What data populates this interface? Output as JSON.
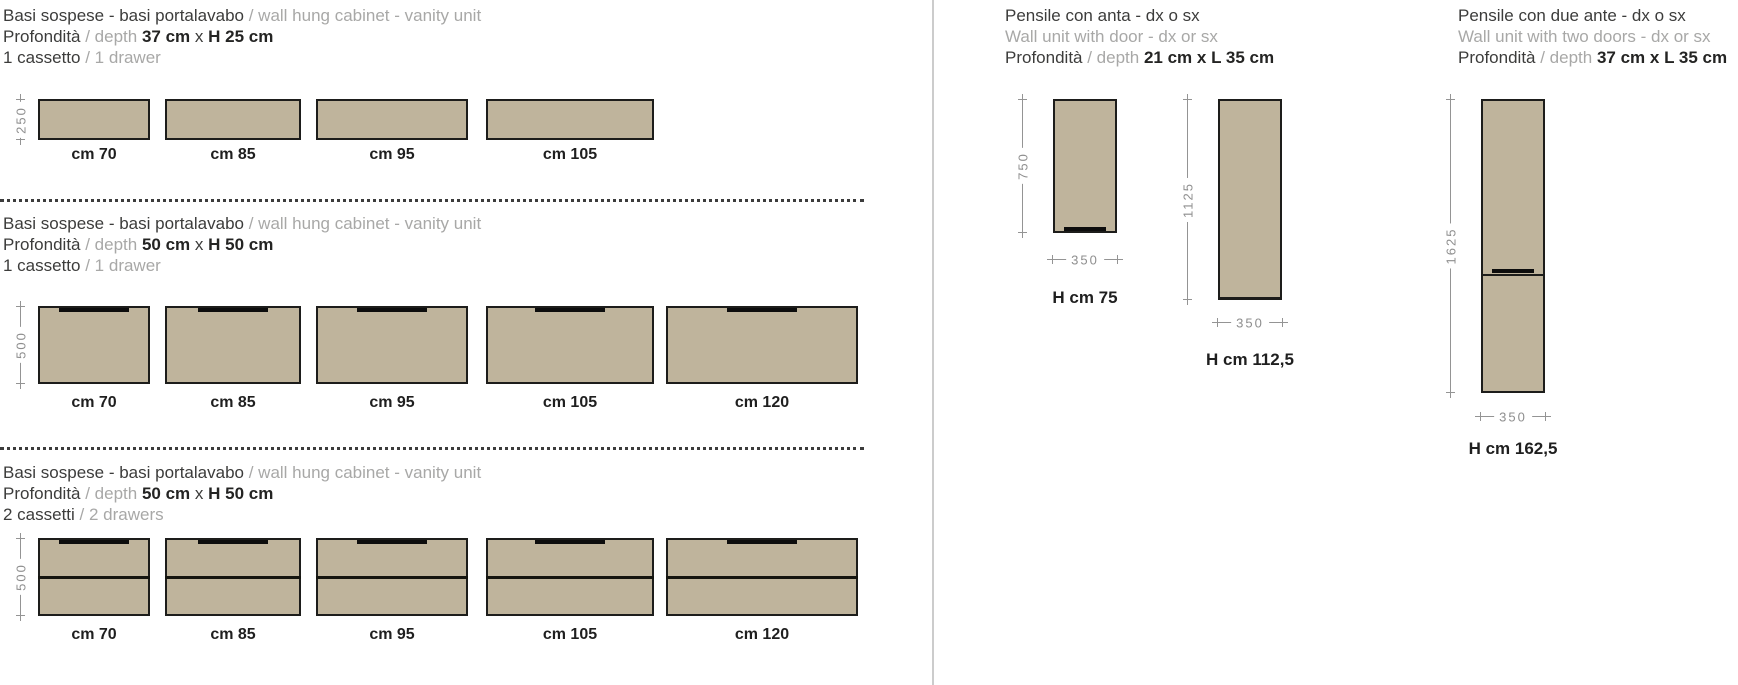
{
  "colors": {
    "cabinet_fill": "#bfb49c",
    "cabinet_border": "#1d1d1b",
    "dimension_gray": "#8e8e8e",
    "muted_text": "#a8a8a7",
    "dark_text": "#3c3c3b"
  },
  "sections": [
    {
      "title_it": "Basi sospese - basi portalavabo",
      "title_en": "/ wall hung cabinet - vanity unit",
      "depth": {
        "it": "Profondità",
        "en": "/ depth",
        "value1": "37 cm",
        "sep": "x",
        "value2": "H 25 cm"
      },
      "drawers": {
        "it": "1 cassetto",
        "en": "/ 1 drawer"
      },
      "dim_height": "250",
      "cabinets": [
        "cm 70",
        "cm 85",
        "cm 95",
        "cm 105"
      ]
    },
    {
      "title_it": "Basi sospese - basi portalavabo",
      "title_en": "/ wall hung cabinet - vanity unit",
      "depth": {
        "it": "Profondità",
        "en": "/ depth",
        "value1": "50 cm",
        "sep": "x",
        "value2": "H 50 cm"
      },
      "drawers": {
        "it": "1 cassetto",
        "en": "/ 1 drawer"
      },
      "dim_height": "500",
      "cabinets": [
        "cm 70",
        "cm 85",
        "cm 95",
        "cm 105",
        "cm 120"
      ]
    },
    {
      "title_it": "Basi sospese - basi portalavabo",
      "title_en": "/ wall hung cabinet - vanity unit",
      "depth": {
        "it": "Profondità",
        "en": "/ depth",
        "value1": "50 cm",
        "sep": "x",
        "value2": "H 50 cm"
      },
      "drawers": {
        "it": "2 cassetti",
        "en": "/ 2 drawers"
      },
      "dim_height": "500",
      "cabinets": [
        "cm 70",
        "cm 85",
        "cm 95",
        "cm 105",
        "cm 120"
      ]
    }
  ],
  "wall_units": [
    {
      "title_it": "Pensile con anta - dx o sx",
      "title_en": "Wall unit with door - dx or sx",
      "depth": {
        "it": "Profondità",
        "en": "/ depth",
        "bold": "21 cm x L 35 cm"
      },
      "items": [
        {
          "dim_height": "750",
          "dim_width": "350",
          "label": "H cm 75"
        },
        {
          "dim_height": "1125",
          "dim_width": "350",
          "label": "H cm 112,5"
        }
      ]
    },
    {
      "title_it": "Pensile con due ante - dx o sx",
      "title_en": "Wall unit with two doors - dx or sx",
      "depth": {
        "it": "Profondità",
        "en": "/ depth",
        "bold": "37 cm x L 35 cm"
      },
      "items": [
        {
          "dim_height": "1625",
          "dim_width": "350",
          "label": "H cm 162,5"
        }
      ]
    }
  ]
}
